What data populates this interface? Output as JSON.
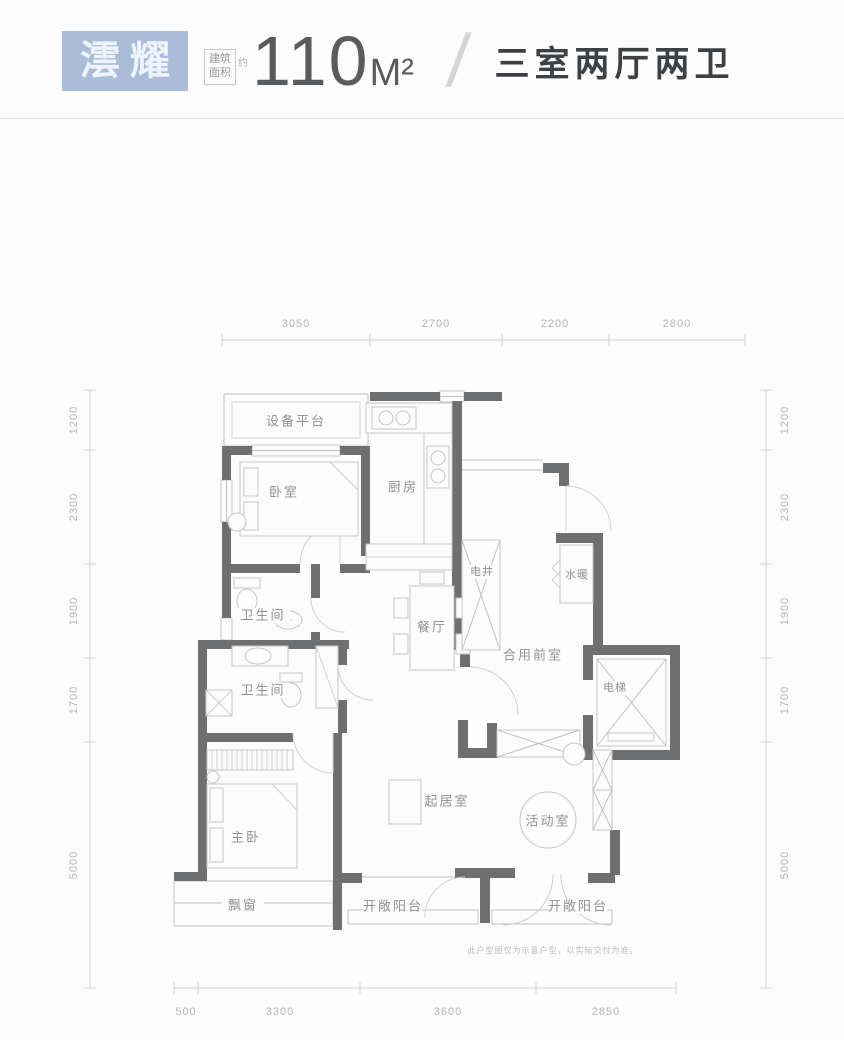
{
  "header": {
    "brand": "澐耀",
    "area_label_top": "建筑",
    "area_label_bottom": "面积",
    "area_approx": "约",
    "area_value": "110",
    "area_unit": "M²",
    "separator": "/",
    "layout_desc": "三室两厅两卫"
  },
  "floorplan": {
    "rooms": {
      "equipment_platform": "设备平台",
      "bedroom": "卧室",
      "kitchen": "厨房",
      "bathroom_1": "卫生间",
      "bathroom_2": "卫生间",
      "dining_room": "餐厅",
      "utility_shaft": "电井",
      "plumbing": "水暖",
      "shared_front_room": "合用前室",
      "elevator": "电梯",
      "master_bedroom": "主卧",
      "living_room": "起居室",
      "activity_room": "活动室",
      "bay_window": "飘窗",
      "open_balcony_left": "开敞阳台",
      "open_balcony_right": "开敞阳台"
    },
    "dimensions": {
      "top": [
        "3050",
        "2700",
        "2200",
        "2800"
      ],
      "bottom": [
        "500",
        "3300",
        "3600",
        "2850"
      ],
      "left": [
        "1200",
        "2300",
        "1900",
        "1700",
        "5000"
      ],
      "right": [
        "1200",
        "2300",
        "1900",
        "1700",
        "5000"
      ]
    },
    "disclaimer": "此户型图仅为示意户型，以实际交付为准。"
  },
  "colors": {
    "brand_bg": "#a9bdd8",
    "wall": "#6e6f70",
    "thin_line": "#c3c6c8",
    "label_text": "#8e9295",
    "dim_text": "#b2b5b7",
    "heading_text": "#3e4144"
  }
}
